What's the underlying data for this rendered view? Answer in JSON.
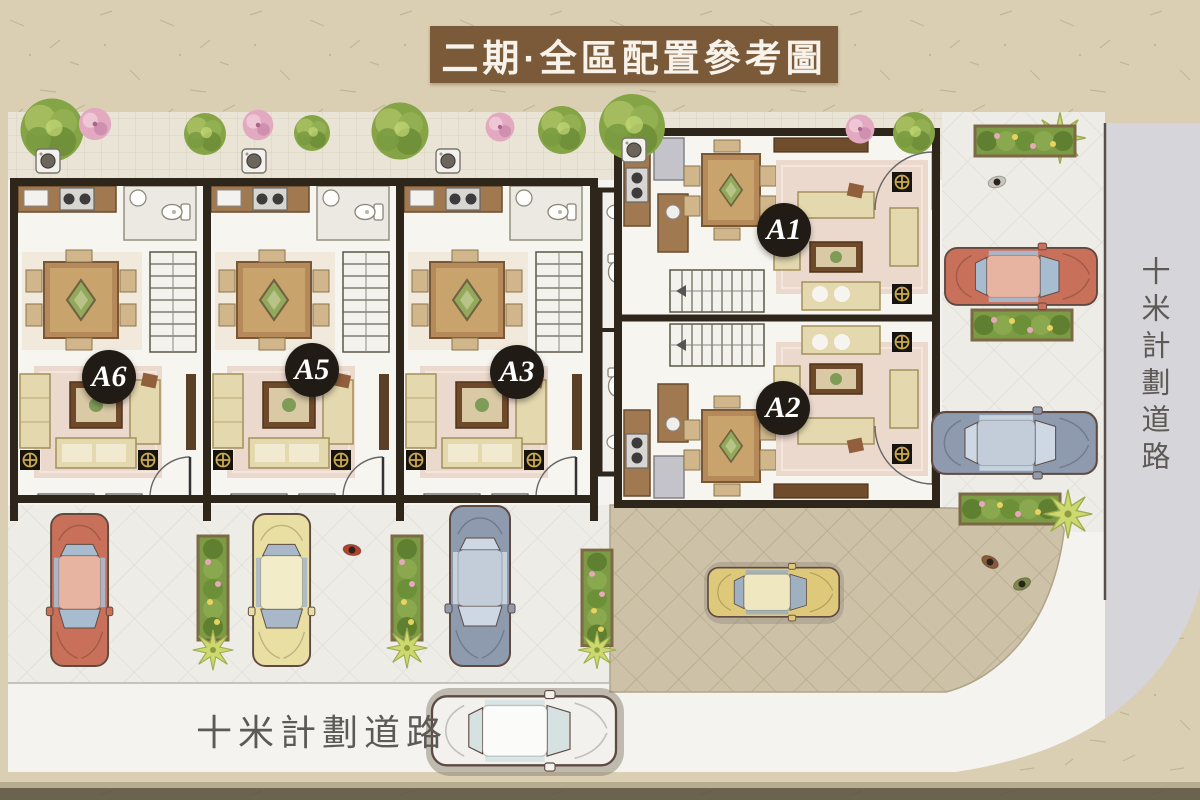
{
  "title": {
    "text": "二期·全區配置參考圖"
  },
  "units": [
    {
      "id": "a1",
      "label": "A1"
    },
    {
      "id": "a2",
      "label": "A2"
    },
    {
      "id": "a3",
      "label": "A3"
    },
    {
      "id": "a5",
      "label": "A5"
    },
    {
      "id": "a6",
      "label": "A6"
    }
  ],
  "roads": {
    "right_label": "十米計劃道路",
    "bottom_label": "十米計劃道路"
  },
  "colors": {
    "banner": "#7b5a3a",
    "paper": "#dacfb2",
    "unit_label_bg": "#201b15",
    "road_text": "#5d5955",
    "hedge_green": "#6f9138",
    "car_red": "#c8705a",
    "car_blue": "#8e9aae",
    "car_yellow": "#e9dfa2",
    "car_white": "#f2f1ed"
  }
}
